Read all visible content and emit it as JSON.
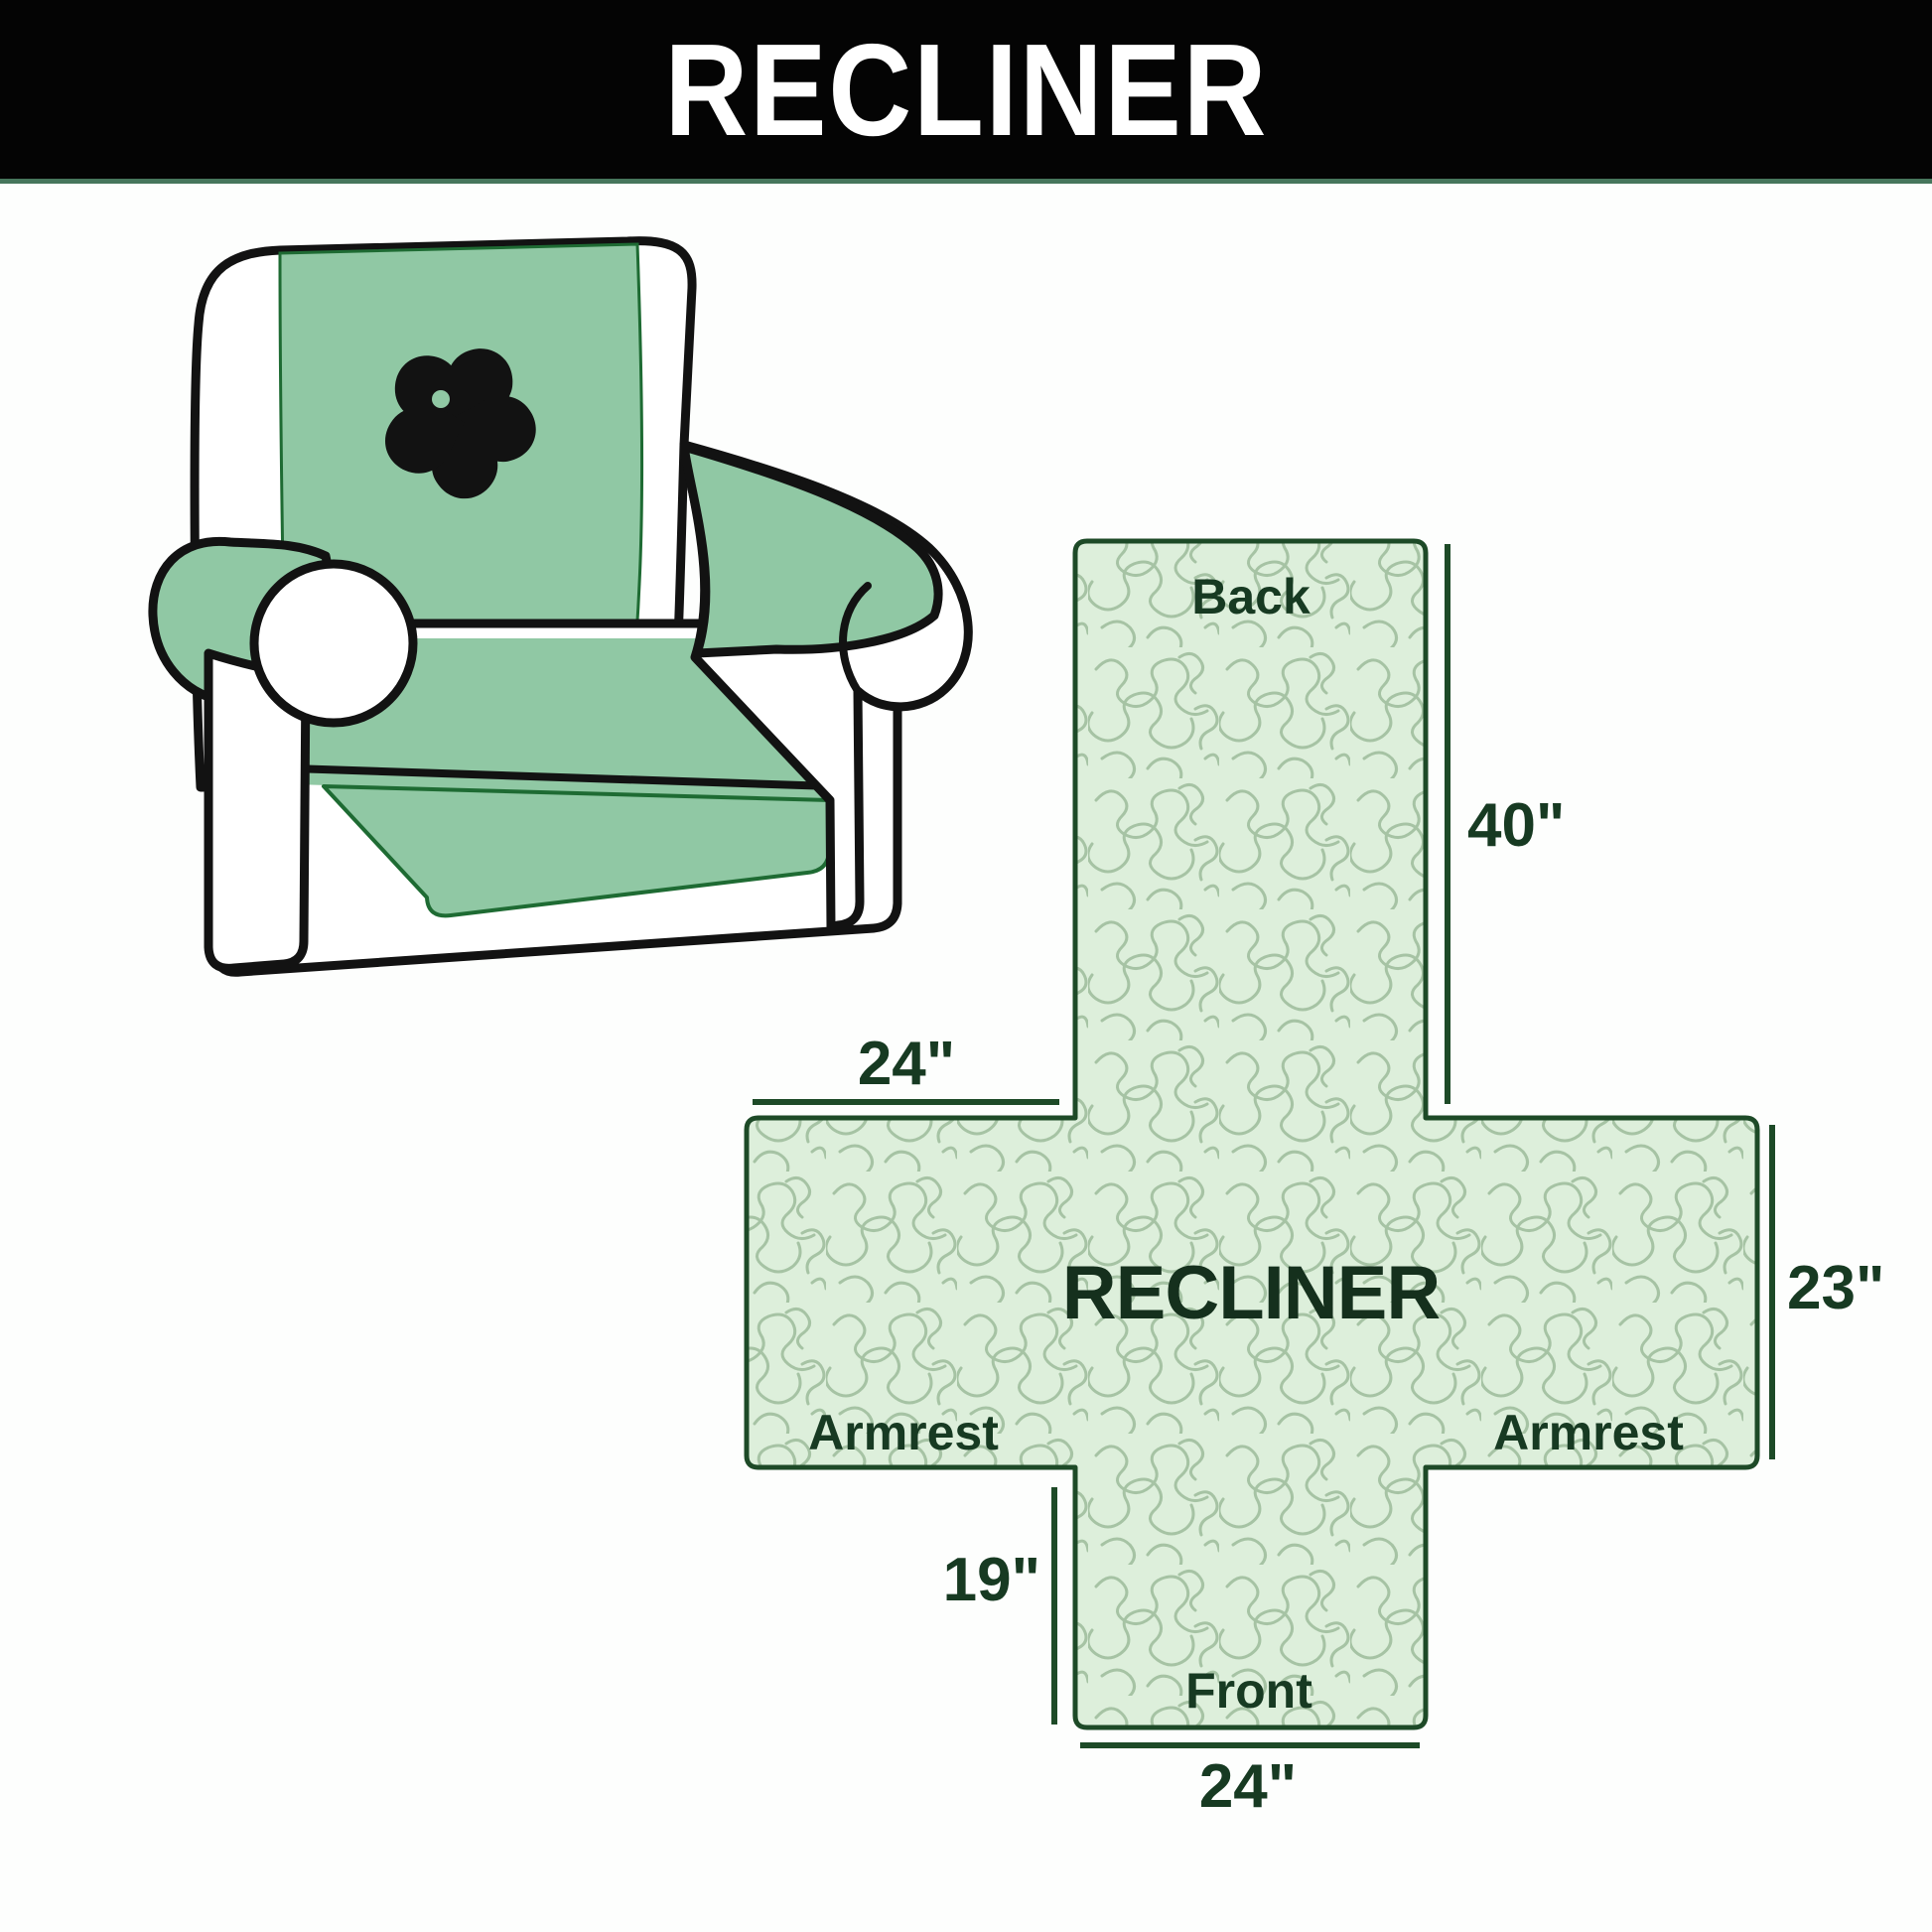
{
  "banner": {
    "title": "RECLINER"
  },
  "chair_illustration": {
    "description": "Armchair with green protective cover and pinwheel logo"
  },
  "pattern_diagram": {
    "center_label": "RECLINER",
    "sections": {
      "back": "Back",
      "armrest_left": "Armrest",
      "armrest_right": "Armrest",
      "front": "Front"
    },
    "measurements": {
      "back_height": "40\"",
      "armrest_top_width": "24\"",
      "armrest_side_height": "23\"",
      "front_flap_height": "19\"",
      "front_width": "24\""
    }
  },
  "colors": {
    "banner_bg": "#040404",
    "banner_text": "#ffffff",
    "cover_green": "#90c8a4",
    "pattern_fill": "#ddefdb",
    "pattern_line": "#a6c3a4",
    "diagram_border": "#1d4a27",
    "label_text": "#173a22",
    "chair_outline": "#121212",
    "cover_edge": "#1e6b33"
  }
}
